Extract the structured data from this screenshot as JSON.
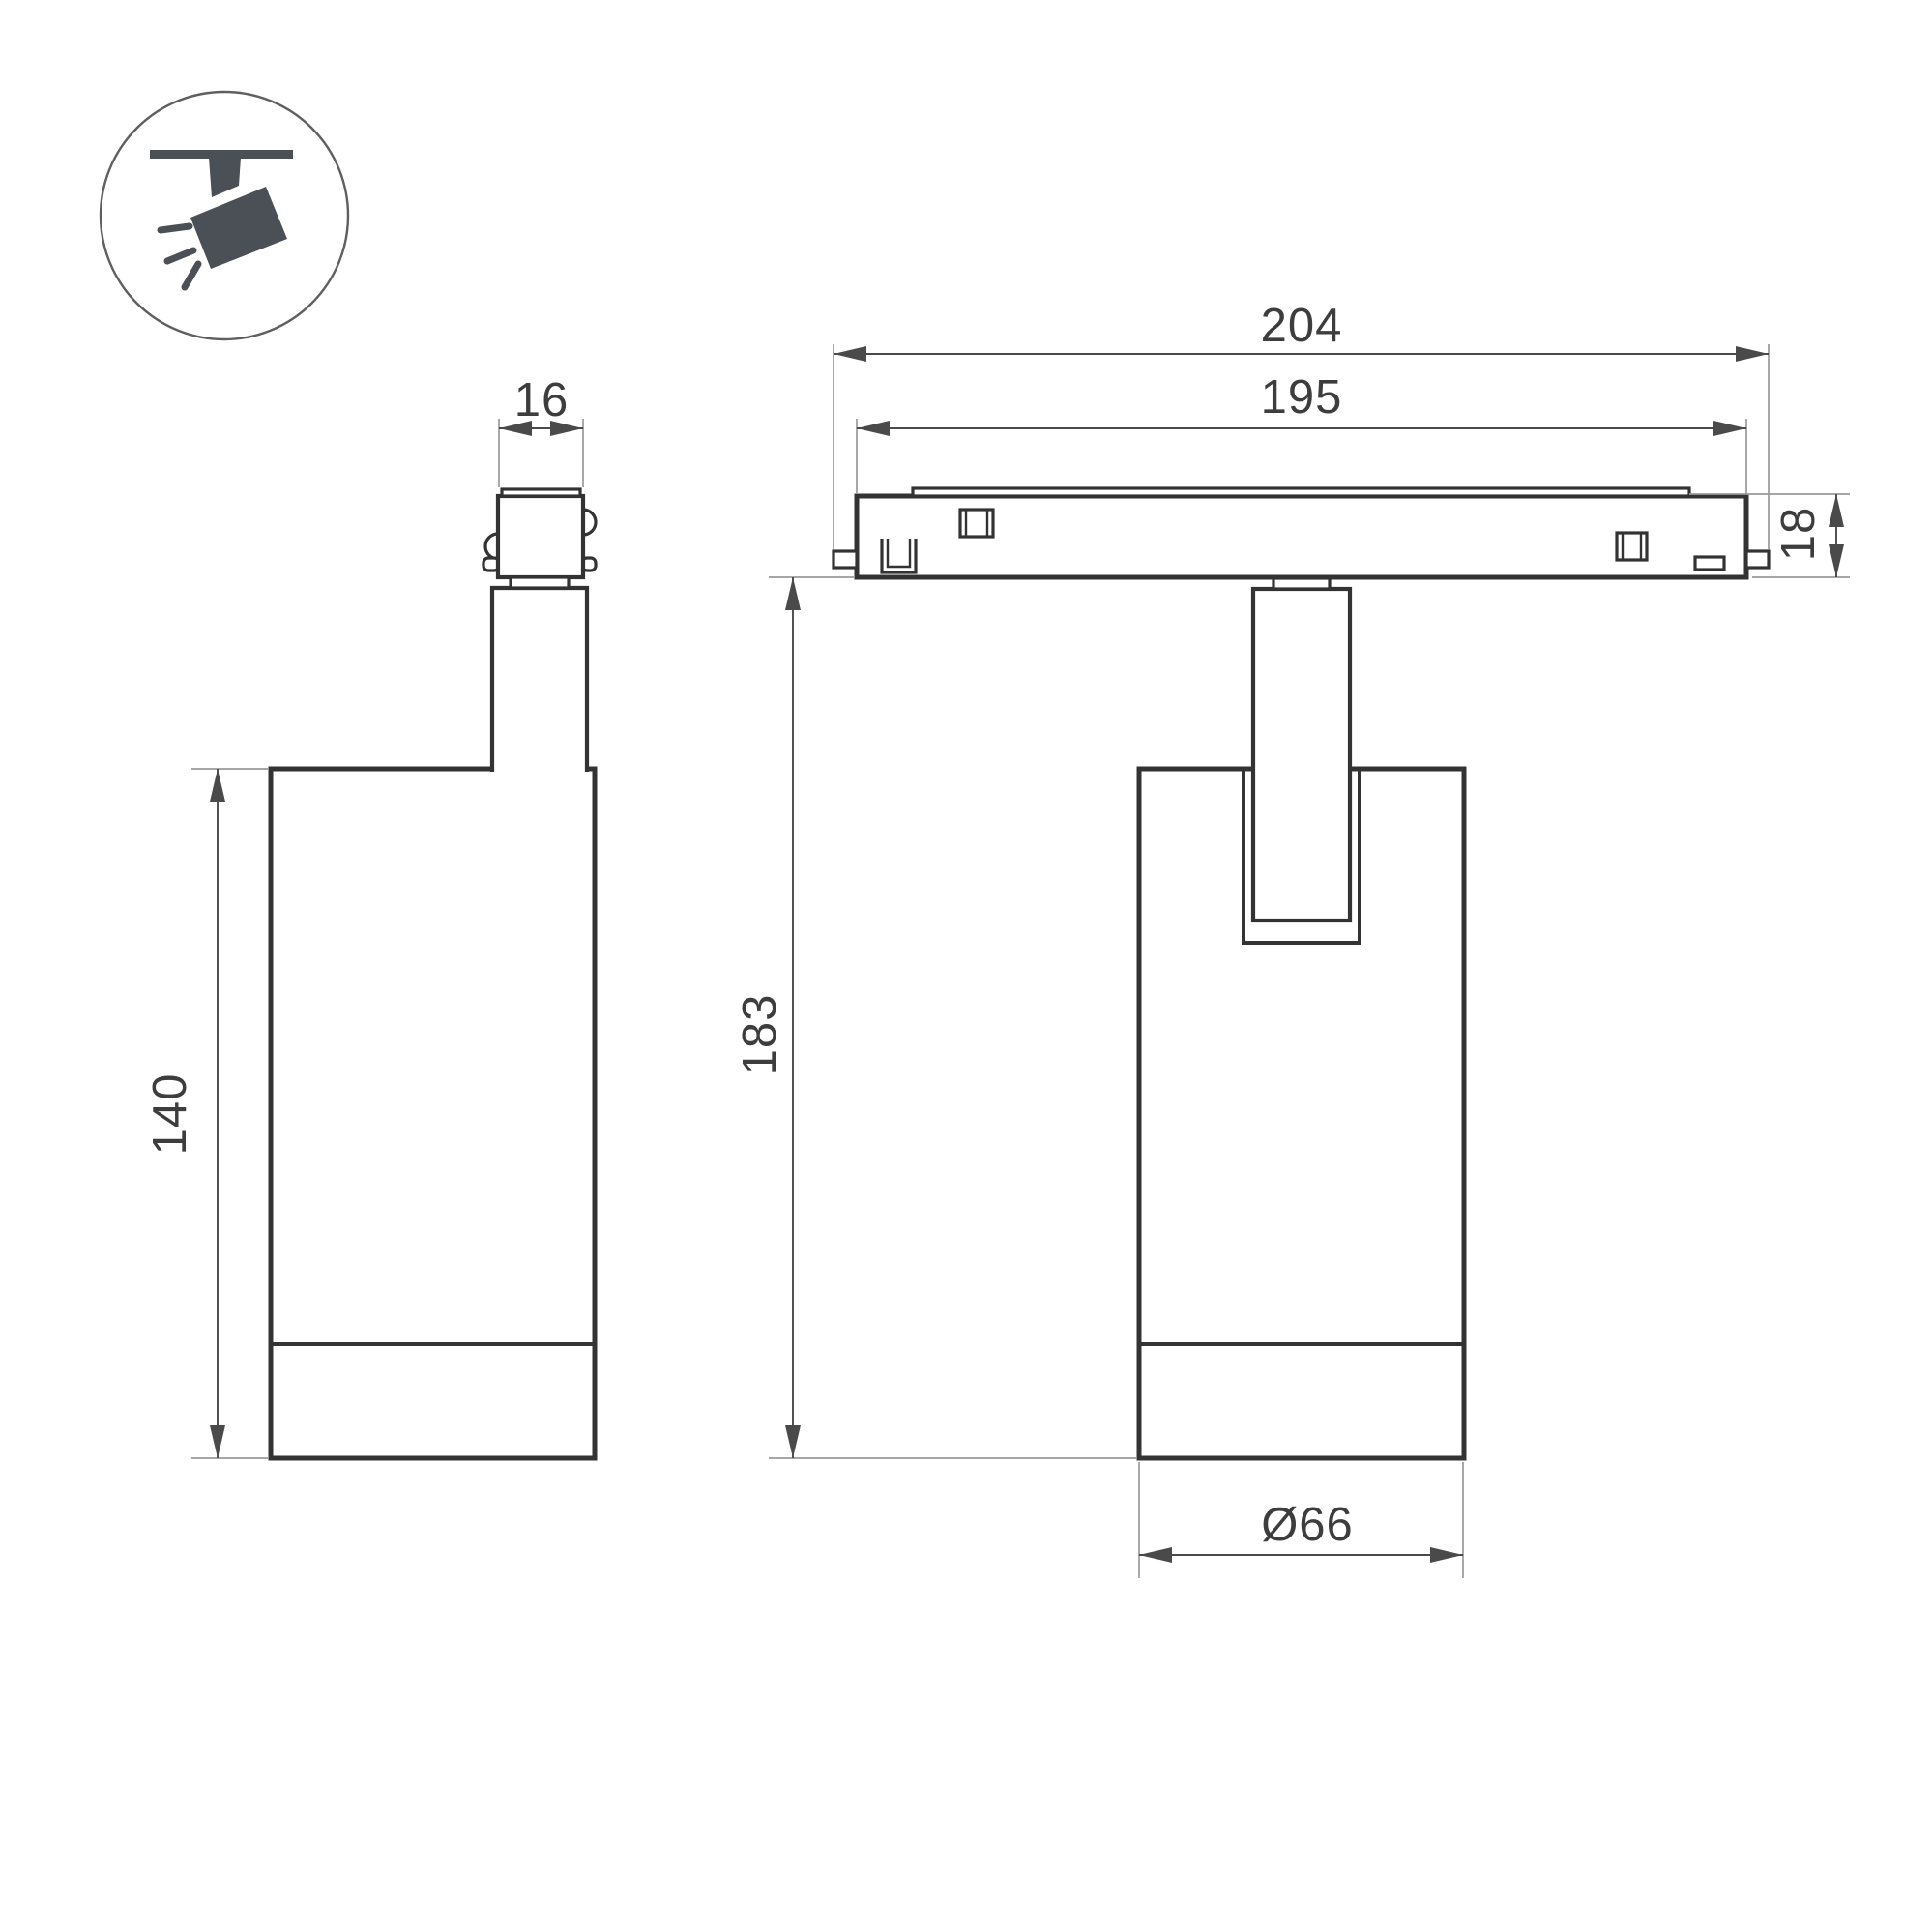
{
  "icon": {
    "name": "track-spotlight-icon"
  },
  "dimensions": {
    "adapter_width": "16",
    "track_outer_length": "204",
    "track_body_length": "195",
    "track_height": "18",
    "total_height": "183",
    "body_height": "140",
    "body_diameter": "Ø66"
  },
  "colors": {
    "line": "#333333",
    "thin_line": "#9a9a9a",
    "dim_line": "#4a4a4a",
    "icon_fill": "#4a5055",
    "text": "#3d3d3d",
    "background": "#ffffff"
  }
}
